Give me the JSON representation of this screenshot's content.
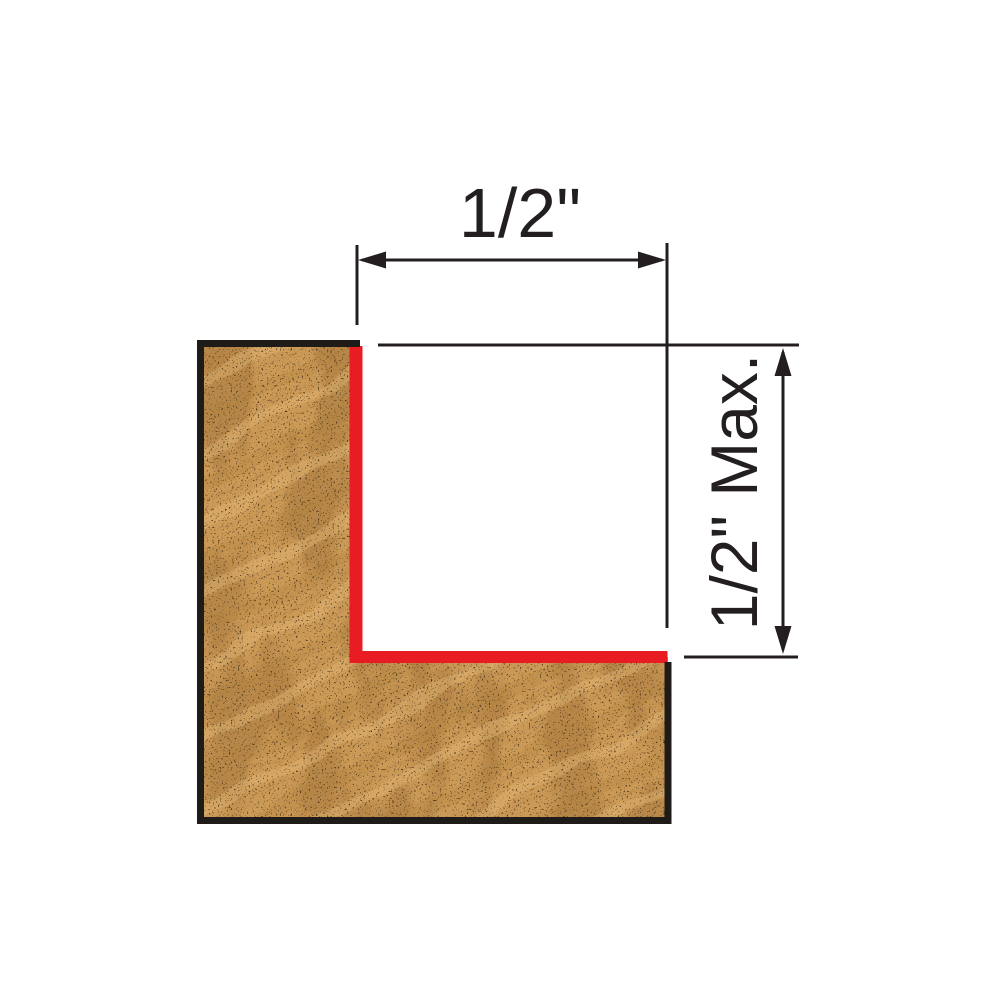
{
  "diagram": {
    "width_dimension": {
      "label": "1/2\""
    },
    "depth_dimension": {
      "label": "1/2\" Max."
    }
  },
  "colors": {
    "background": "#ffffff",
    "outline": "#1e1b18",
    "dimension": "#231f20",
    "cut_line": "#e91c23",
    "wood_base": "#cc9a57",
    "wood_band_dark": "#ad7c3d",
    "wood_band_light": "#e2b878",
    "wood_speckle": "#3e2b15",
    "wood_blotch": "#8a5f2a"
  }
}
